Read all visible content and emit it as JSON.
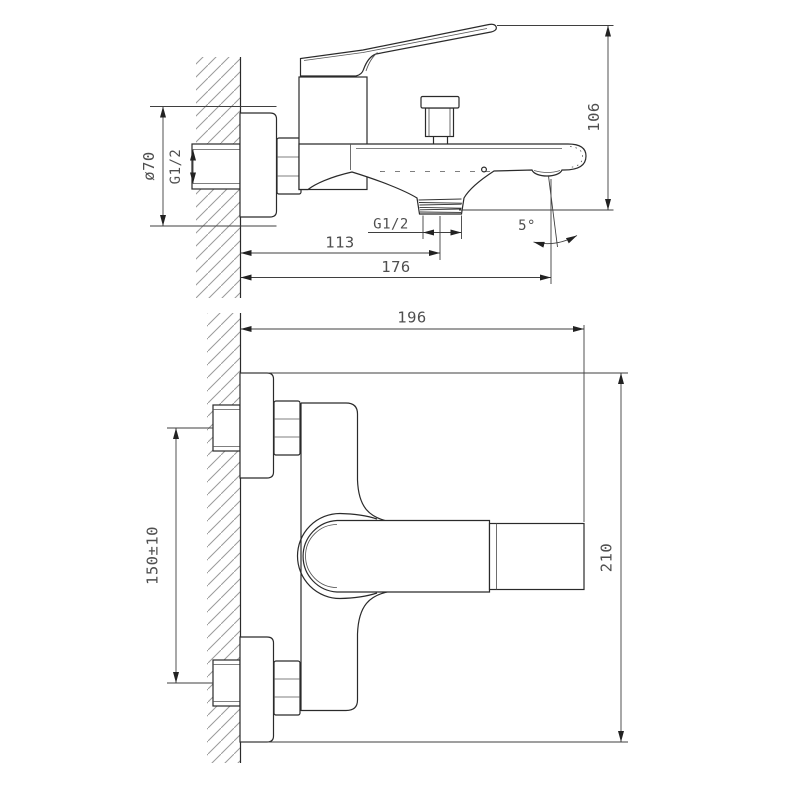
{
  "drawing": {
    "type": "technical-dimension-drawing",
    "subject": "wall-mounted bath mixer faucet, two orthographic views",
    "line_color": "#2a2a2a",
    "dimension_color": "#4f4f4f",
    "hatch_color": "#9a9a9a",
    "background": "#ffffff",
    "side_view": {
      "flange_diameter": "ø70",
      "inlet_thread": "G1/2",
      "overall_height": "106",
      "wall_to_shower_outlet": "113",
      "wall_to_spout_outlet": "176",
      "shower_outlet_thread": "G1/2",
      "spout_angle": "5°"
    },
    "plan_view": {
      "wall_to_front": "196",
      "inlet_centres_spacing": "150±10",
      "overall_width": "210"
    }
  }
}
